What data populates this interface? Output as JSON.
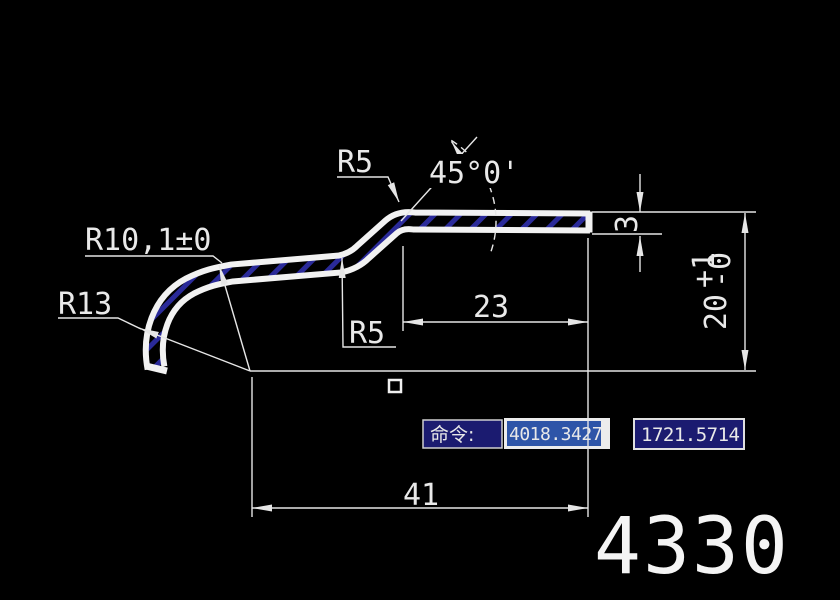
{
  "app": {
    "background_color": "#000000",
    "line_color": "#e6e6e6",
    "part_fill_color": "#f2f2f2",
    "hatch_color": "#2a2a99",
    "box_blue": "#1b1b70",
    "selection_blue": "#2e55a8"
  },
  "drawing": {
    "dims": {
      "r5_top": "R5",
      "r5_bottom": "R5",
      "r13": "R13",
      "r10": "R10,1±0",
      "angle": "45°0'",
      "len_23": "23",
      "thk_3": "3",
      "h20": "20",
      "h20_tol_plus": "+1",
      "h20_tol_minus": "-0",
      "len_41": "41"
    },
    "part_number": "4330"
  },
  "command_bar": {
    "prompt": "命令:",
    "coord_x": "4018.3427",
    "coord_y": "1721.5714"
  }
}
